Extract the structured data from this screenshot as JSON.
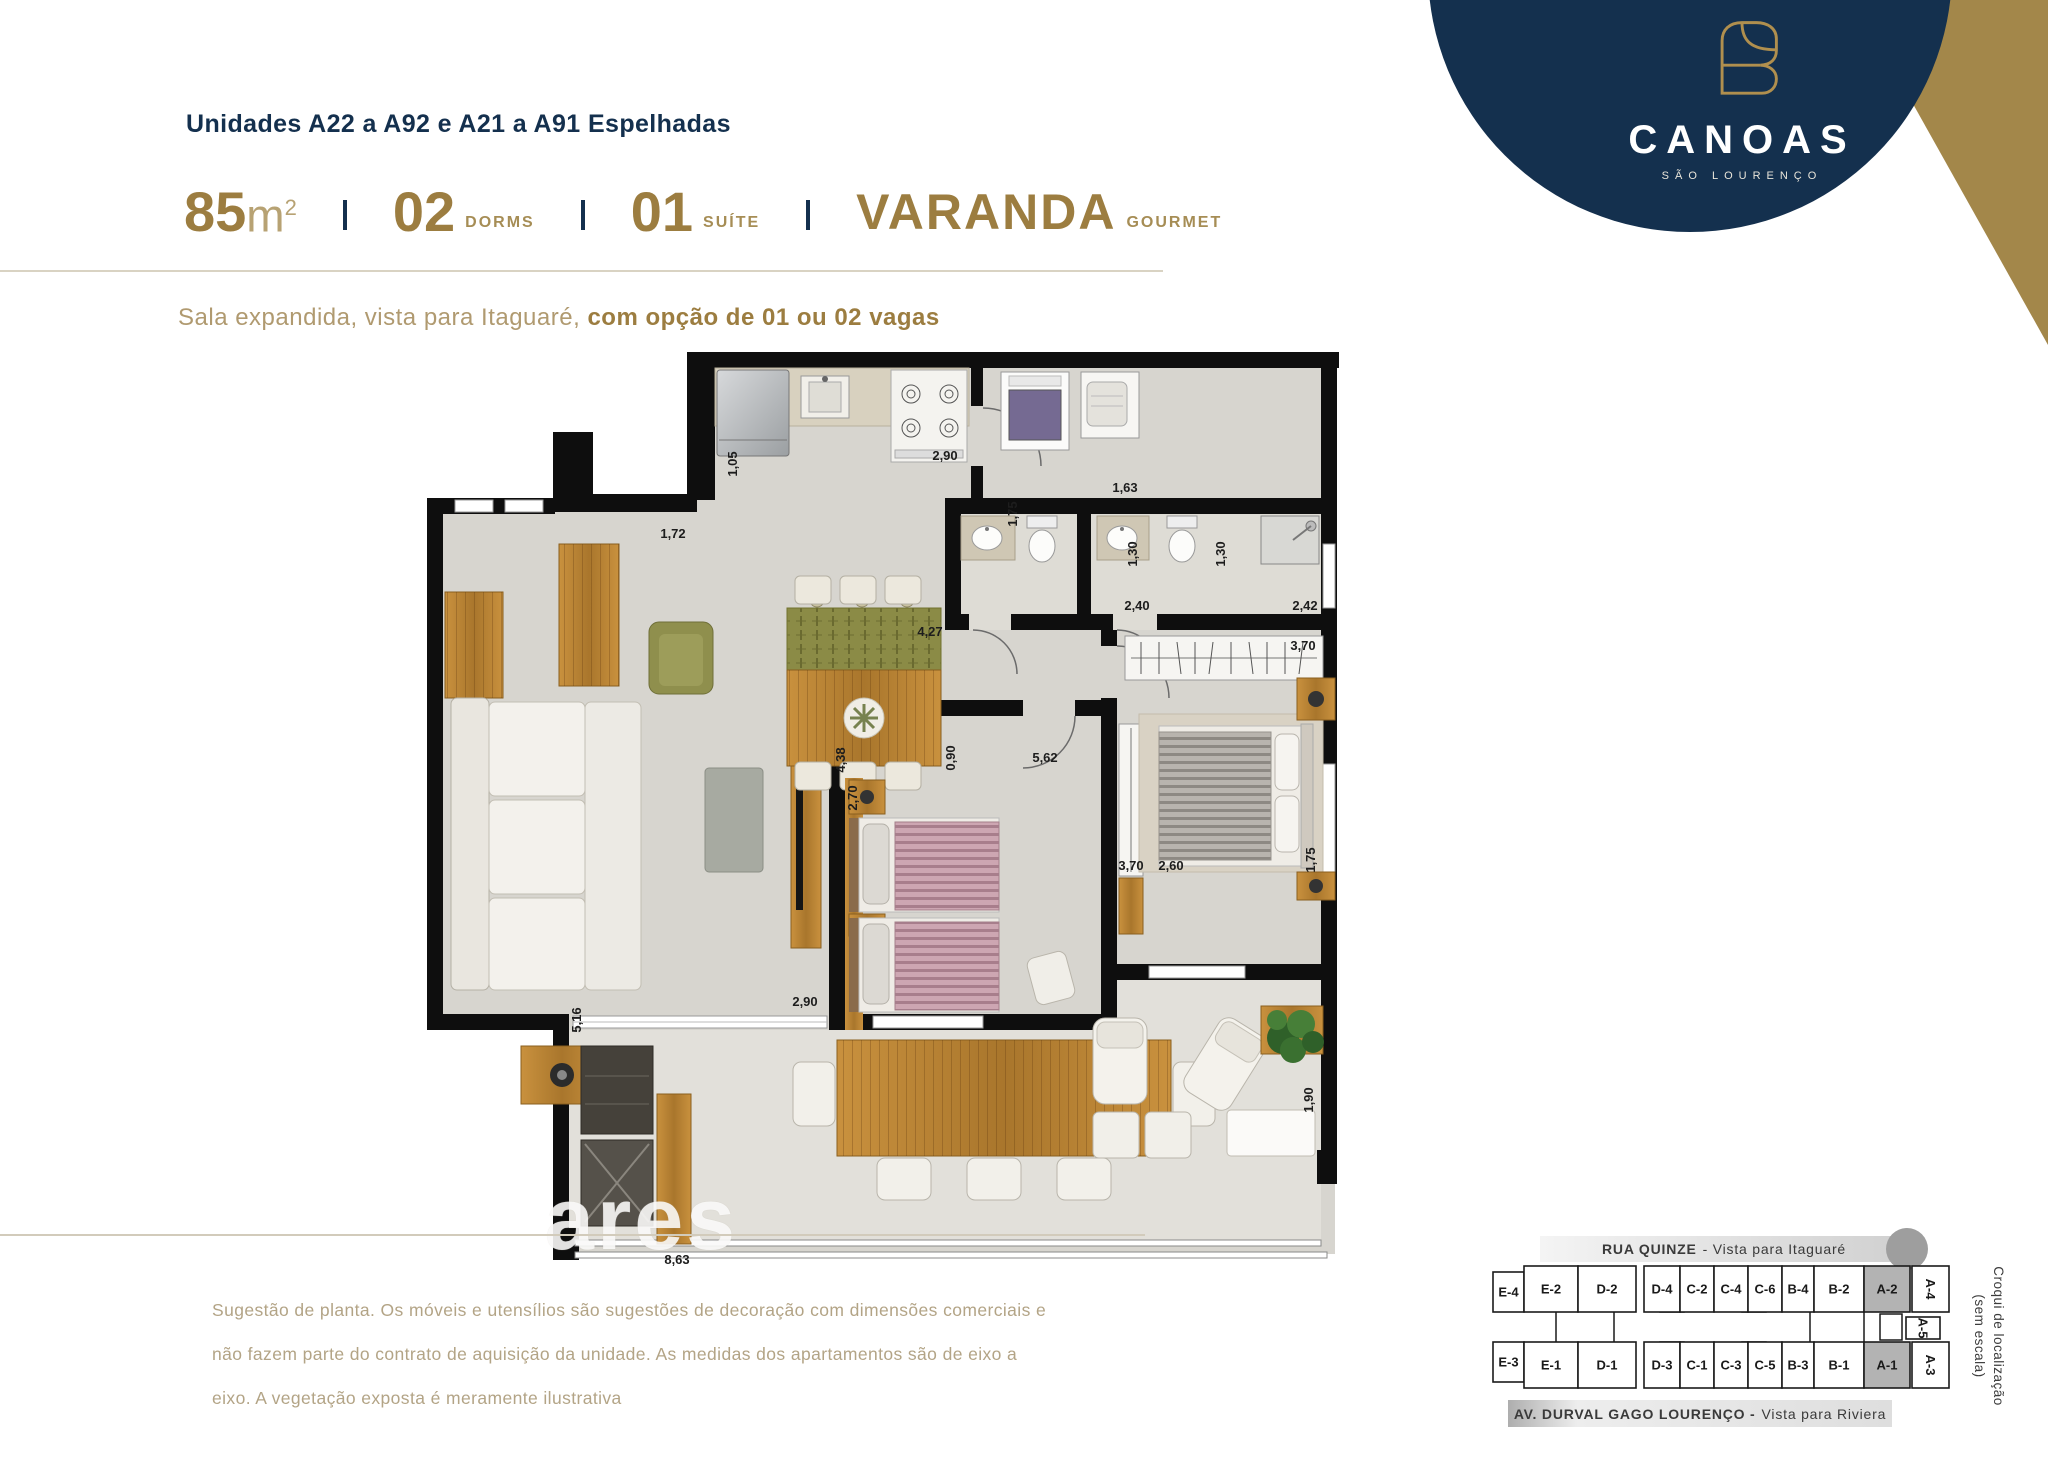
{
  "colors": {
    "navy": "#14304e",
    "gold": "#9c7d40",
    "gold_light": "#b7a273",
    "subtitle_regular": "#b09a70",
    "disclaimer": "#b3a486",
    "divider": "#d9d3c3",
    "croqui_gray": "#9e9e9e",
    "croqui_highlight": "#b3b3b3",
    "wall": "#0e0e0e",
    "floor": "#d7d5cf"
  },
  "header": {
    "title": "Unidades A22 a A92 e A21 a A91 Espelhadas",
    "specs": [
      {
        "big": "85",
        "unit": "m²"
      },
      {
        "big": "02",
        "small": "DORMS"
      },
      {
        "big": "01",
        "small": "SUÍTE"
      },
      {
        "big": "VARANDA",
        "small": "GOURMET",
        "vara": true
      }
    ],
    "subtitle_regular": "Sala expandida, vista para Itaguaré, ",
    "subtitle_bold": "com opção de 01 ou 02 vagas"
  },
  "brand": {
    "name": "CANOAS",
    "subname": "SÃO LOURENÇO",
    "icon": "canoas-leaf-monogram"
  },
  "floor_plan": {
    "watermark": "ares",
    "dimensions": [
      {
        "t": "1,72",
        "x": 248,
        "y": 190
      },
      {
        "t": "1,05",
        "x": 312,
        "y": 116,
        "r": true
      },
      {
        "t": "2,90",
        "x": 520,
        "y": 112
      },
      {
        "t": "1,75",
        "x": 592,
        "y": 166,
        "r": true
      },
      {
        "t": "1,63",
        "x": 700,
        "y": 144
      },
      {
        "t": "1,30",
        "x": 712,
        "y": 206,
        "r": true
      },
      {
        "t": "1,30",
        "x": 800,
        "y": 206,
        "r": true
      },
      {
        "t": "2,40",
        "x": 712,
        "y": 262
      },
      {
        "t": "2,42",
        "x": 880,
        "y": 262
      },
      {
        "t": "3,70",
        "x": 878,
        "y": 302
      },
      {
        "t": "4,27",
        "x": 505,
        "y": 288
      },
      {
        "t": "4,38",
        "x": 420,
        "y": 412,
        "r": true
      },
      {
        "t": "0,90",
        "x": 530,
        "y": 410,
        "r": true
      },
      {
        "t": "5,62",
        "x": 620,
        "y": 414
      },
      {
        "t": "2,70",
        "x": 432,
        "y": 450,
        "r": true
      },
      {
        "t": "3,70",
        "x": 706,
        "y": 522
      },
      {
        "t": "2,60",
        "x": 746,
        "y": 522
      },
      {
        "t": "1,75",
        "x": 890,
        "y": 512,
        "r": true
      },
      {
        "t": "5,16",
        "x": 156,
        "y": 672,
        "r": true
      },
      {
        "t": "2,90",
        "x": 380,
        "y": 658
      },
      {
        "t": "1,90",
        "x": 888,
        "y": 752,
        "r": true
      },
      {
        "t": "8,63",
        "x": 252,
        "y": 916
      }
    ]
  },
  "footer": {
    "disclaimer_lines": [
      "Sugestão de planta. Os móveis e utensílios são sugestões de decoração com dimensões comerciais e",
      "não fazem parte do contrato de aquisição da unidade. As medidas dos apartamentos são de eixo a",
      "eixo. A vegetação exposta é meramente ilustrativa"
    ]
  },
  "croqui": {
    "street_top_bold": "RUA QUINZE",
    "street_top_rest": "- Vista para Itaguaré",
    "street_bottom_bold": "AV. DURVAL GAGO LOURENÇO -",
    "street_bottom_rest": "Vista para Riviera",
    "side_note_line1": "Croqui de localização",
    "side_note_line2": "(sem escala)",
    "units": [
      {
        "label": "E-4",
        "x": 1,
        "y": 8,
        "w": 31,
        "h": 40
      },
      {
        "label": "E-2",
        "x": 32,
        "y": 2,
        "w": 54,
        "h": 46
      },
      {
        "label": "D-2",
        "x": 86,
        "y": 2,
        "w": 58,
        "h": 46
      },
      {
        "label": "D-4",
        "x": 152,
        "y": 2,
        "w": 36,
        "h": 46
      },
      {
        "label": "C-2",
        "x": 188,
        "y": 2,
        "w": 34,
        "h": 46
      },
      {
        "label": "C-4",
        "x": 222,
        "y": 2,
        "w": 34,
        "h": 46
      },
      {
        "label": "C-6",
        "x": 256,
        "y": 2,
        "w": 34,
        "h": 46
      },
      {
        "label": "B-4",
        "x": 290,
        "y": 2,
        "w": 32,
        "h": 46
      },
      {
        "label": "B-2",
        "x": 322,
        "y": 2,
        "w": 50,
        "h": 46
      },
      {
        "label": "A-2",
        "x": 372,
        "y": 2,
        "w": 46,
        "h": 46,
        "hl": true
      },
      {
        "label": "A-4",
        "x": 420,
        "y": 2,
        "w": 37,
        "h": 46,
        "rot": true
      },
      {
        "label": "A-5",
        "x": 414,
        "y": 53,
        "w": 34,
        "h": 22,
        "rot": true
      },
      {
        "label": "E-3",
        "x": 1,
        "y": 78,
        "w": 31,
        "h": 40
      },
      {
        "label": "E-1",
        "x": 32,
        "y": 78,
        "w": 54,
        "h": 46
      },
      {
        "label": "D-1",
        "x": 86,
        "y": 78,
        "w": 58,
        "h": 46
      },
      {
        "label": "D-3",
        "x": 152,
        "y": 78,
        "w": 36,
        "h": 46
      },
      {
        "label": "C-1",
        "x": 188,
        "y": 78,
        "w": 34,
        "h": 46
      },
      {
        "label": "C-3",
        "x": 222,
        "y": 78,
        "w": 34,
        "h": 46
      },
      {
        "label": "C-5",
        "x": 256,
        "y": 78,
        "w": 34,
        "h": 46
      },
      {
        "label": "B-3",
        "x": 290,
        "y": 78,
        "w": 32,
        "h": 46
      },
      {
        "label": "B-1",
        "x": 322,
        "y": 78,
        "w": 50,
        "h": 46
      },
      {
        "label": "A-1",
        "x": 372,
        "y": 78,
        "w": 46,
        "h": 46,
        "hl": true
      },
      {
        "label": "A-3",
        "x": 420,
        "y": 78,
        "w": 37,
        "h": 46,
        "rot": true
      }
    ]
  }
}
